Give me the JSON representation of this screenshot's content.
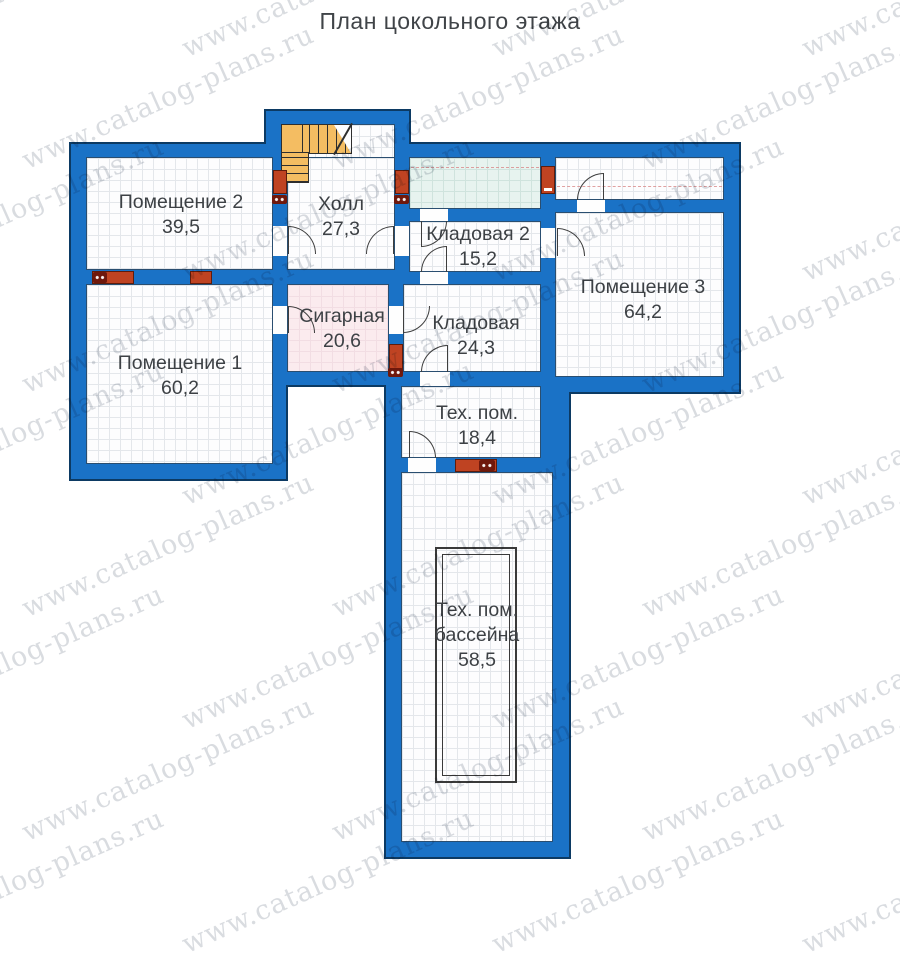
{
  "title": "План цокольного этажа",
  "watermark": {
    "text": "www.catalog-plans.ru",
    "color": "#aab0ba"
  },
  "colors": {
    "wall_fill": "#1a72c6",
    "wall_outline": "#0c3a63",
    "vent": "#bf4322",
    "stair": "#f4bd62",
    "cigar_room_floor": "#fbebee",
    "vestibule_floor": "#e7f3ef"
  },
  "rooms": [
    {
      "id": "room-2",
      "name": "Помещение 2",
      "area": "39,5",
      "label_x": 181,
      "label_y": 190
    },
    {
      "id": "hall",
      "name": "Холл",
      "area": "27,3",
      "label_x": 341,
      "label_y": 192
    },
    {
      "id": "storage-2",
      "name": "Кладовая 2",
      "area": "15,2",
      "label_x": 478,
      "label_y": 222
    },
    {
      "id": "room-3",
      "name": "Помещение 3",
      "area": "64,2",
      "label_x": 643,
      "label_y": 275
    },
    {
      "id": "cigar",
      "name": "Сигарная",
      "area": "20,6",
      "label_x": 342,
      "label_y": 304
    },
    {
      "id": "storage",
      "name": "Кладовая",
      "area": "24,3",
      "label_x": 476,
      "label_y": 311
    },
    {
      "id": "room-1",
      "name": "Помещение 1",
      "area": "60,2",
      "label_x": 180,
      "label_y": 351
    },
    {
      "id": "tech",
      "name": "Тех. пом.",
      "area": "18,4",
      "label_x": 477,
      "label_y": 401
    },
    {
      "id": "pool-tech",
      "name": "Тех. пом.",
      "name2": "бассейна",
      "area": "58,5",
      "label_x": 477,
      "label_y": 598
    }
  ]
}
